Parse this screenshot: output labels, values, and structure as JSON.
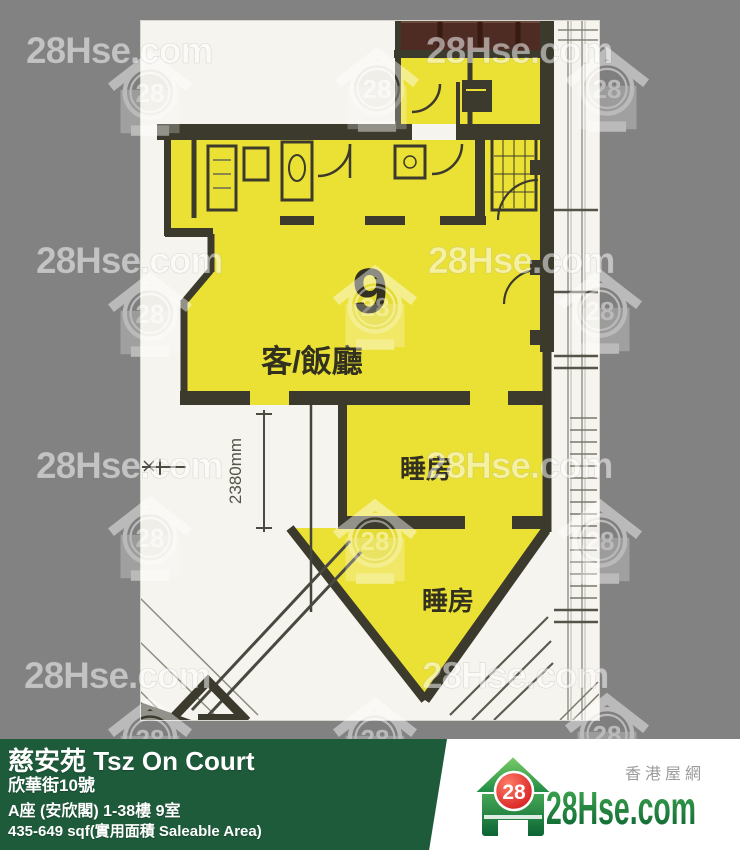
{
  "info_bar": {
    "estate_name": "慈安苑 Tsz On Court",
    "address": "欣華街10號",
    "block_floor_unit": "A座 (安欣閣) 1-38樓 9室",
    "area": "435-649 sqf(實用面積 Saleable Area)",
    "background_color": "#1e5b3b"
  },
  "brand": {
    "site_name": "28Hse.com",
    "site_name_cn": "香港屋網",
    "logo_number": "28",
    "logo_red": "#d6121b",
    "logo_green_dark": "#0d6a33",
    "logo_green_light": "#3fae58"
  },
  "watermark": {
    "text": "28Hse.com",
    "logo_number": "28"
  },
  "floor_plan": {
    "unit_number": "9",
    "living_dining_label": "客/飯廳",
    "bedroom_label_1": "睡房",
    "bedroom_label_2": "睡房",
    "dimension_label": "2380mm",
    "highlight_color": "#ebe135",
    "wall_color": "#3c3a2c"
  },
  "page": {
    "background_color": "#828282"
  }
}
